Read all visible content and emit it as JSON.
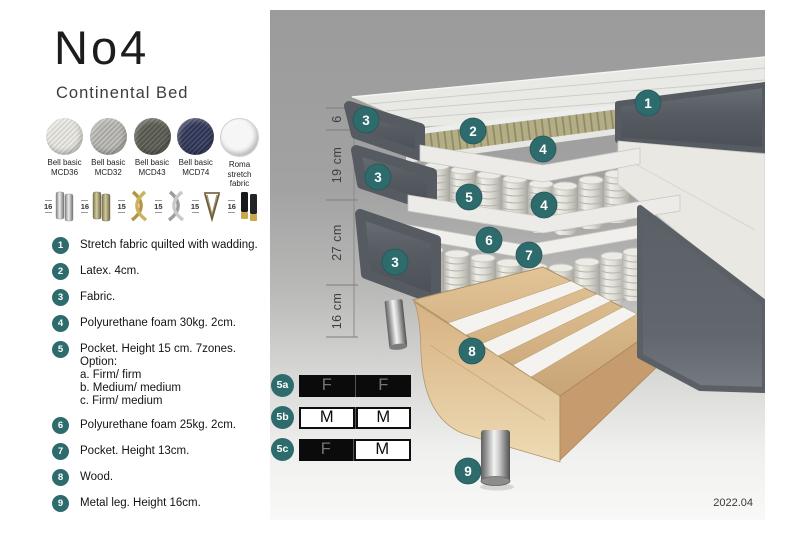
{
  "title": {
    "name": "No4",
    "subtitle": "Continental Bed"
  },
  "swatches": [
    {
      "line1": "Bell basic",
      "line2": "MCD36",
      "base": "#d6d4cd",
      "weave": "#efeeea"
    },
    {
      "line1": "Bell basic",
      "line2": "MCD32",
      "base": "#a7a6a2",
      "weave": "#c6c5c1"
    },
    {
      "line1": "Bell basic",
      "line2": "MCD43",
      "base": "#54554d",
      "weave": "#6e6f66"
    },
    {
      "line1": "Bell basic",
      "line2": "MCD74",
      "base": "#2d3350",
      "weave": "#4a5070"
    },
    {
      "line1": "Roma",
      "line2": "stretch fabric",
      "base": "#f6f6f6",
      "weave": "#f6f6f6"
    }
  ],
  "legs": [
    {
      "height": "16",
      "style": "cyl-silver"
    },
    {
      "height": "16",
      "style": "cyl-brass"
    },
    {
      "height": "15",
      "style": "twist-gold"
    },
    {
      "height": "15",
      "style": "twist-silver"
    },
    {
      "height": "15",
      "style": "hairpin"
    },
    {
      "height": "16",
      "style": "cyl-blackgold"
    }
  ],
  "legend": [
    {
      "num": "1",
      "text": "Stretch fabric quilted with wadding."
    },
    {
      "num": "2",
      "text": "Latex. 4cm."
    },
    {
      "num": "3",
      "text": "Fabric."
    },
    {
      "num": "4",
      "text": "Polyurethane foam 30kg. 2cm."
    },
    {
      "num": "5",
      "text": "Pocket. Height 15 cm. 7zones. Option:",
      "sub": [
        "a. Firm/ firm",
        "b. Medium/ medium",
        "c. Firm/ medium"
      ]
    },
    {
      "num": "6",
      "text": "Polyurethane foam 25kg. 2cm."
    },
    {
      "num": "7",
      "text": "Pocket. Height 13cm."
    },
    {
      "num": "8",
      "text": "Wood."
    },
    {
      "num": "9",
      "text": "Metal leg. Height 16cm."
    }
  ],
  "firmness": [
    {
      "id": "5a",
      "cells": [
        {
          "letter": "F",
          "filled": true
        },
        {
          "letter": "F",
          "filled": true
        }
      ]
    },
    {
      "id": "5b",
      "cells": [
        {
          "letter": "M",
          "filled": false
        },
        {
          "letter": "M",
          "filled": false
        }
      ]
    },
    {
      "id": "5c",
      "cells": [
        {
          "letter": "F",
          "filled": true
        },
        {
          "letter": "M",
          "filled": false
        }
      ]
    }
  ],
  "measurements": [
    {
      "label": "6",
      "from": 108,
      "to": 130
    },
    {
      "label": "19 cm",
      "from": 130,
      "to": 200
    },
    {
      "label": "27 cm",
      "from": 200,
      "to": 285
    },
    {
      "label": "16 cm",
      "from": 285,
      "to": 337
    }
  ],
  "callouts": [
    {
      "num": "1",
      "x": 648,
      "y": 103
    },
    {
      "num": "2",
      "x": 473,
      "y": 131
    },
    {
      "num": "3",
      "x": 366,
      "y": 120
    },
    {
      "num": "3",
      "x": 378,
      "y": 177
    },
    {
      "num": "3",
      "x": 395,
      "y": 262
    },
    {
      "num": "4",
      "x": 543,
      "y": 149
    },
    {
      "num": "4",
      "x": 544,
      "y": 205
    },
    {
      "num": "5",
      "x": 469,
      "y": 197
    },
    {
      "num": "6",
      "x": 489,
      "y": 240
    },
    {
      "num": "7",
      "x": 529,
      "y": 255
    },
    {
      "num": "8",
      "x": 472,
      "y": 351
    },
    {
      "num": "9",
      "x": 468,
      "y": 471
    }
  ],
  "footer": {
    "version": "2022.04"
  },
  "colors": {
    "badge_teal": "#2e6b6d",
    "dark_fabric": "#555a61",
    "latex": "#b4ae86",
    "wood": "#d4ae7e",
    "panel_gray": "#9b9b9b"
  }
}
